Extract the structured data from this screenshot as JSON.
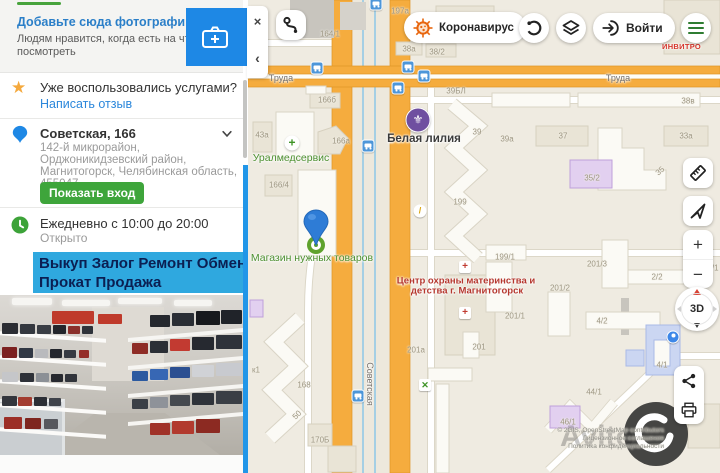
{
  "colors": {
    "brand_blue": "#1E88E5",
    "link_blue": "#2b87db",
    "green": "#3EA53B",
    "banner_bg": "#2FA8DF",
    "banner_text": "#0B1F52",
    "road_orange": "#F5AC3E",
    "map_bg": "#EFEBE1",
    "poi_green": "#4C8F2F",
    "poi_red": "#B5372E",
    "purple": "#6F4FA0"
  },
  "sidebar": {
    "photo_prompt": {
      "title": "Добавьте сюда фотографий!",
      "subtitle_line1": "Людям нравится, когда есть на что",
      "subtitle_line2": "посмотреть"
    },
    "review": {
      "question": "Уже воспользовались услугами?",
      "link": "Написать отзыв"
    },
    "address": {
      "title": "Советская, 166",
      "line1": "142-й микрорайон,",
      "line2": "Орджоникидзевский район,",
      "line3": "Магнитогорск, Челябинская область,",
      "line4": "455047",
      "entrance_button": "Показать вход"
    },
    "hours": {
      "schedule": "Ежедневно с 10:00 до 20:00",
      "status": "Открыто"
    },
    "banner": {
      "line1": "Выкуп Залог Ремонт Обмен",
      "line2": "Прокат Продажа"
    }
  },
  "map": {
    "panel": {
      "close": "×",
      "collapse": "‹"
    },
    "toolbar": {
      "coronavirus_label": "Коронавирус",
      "login_label": "Войти"
    },
    "invitro_label": "ИНВИТРО",
    "controls": {
      "zoom_in": "+",
      "zoom_out": "−",
      "threed": "3D"
    },
    "attribution": {
      "copyright": "© 2GIS, OpenStreetMap contributors",
      "license": "Лицензионное соглашение",
      "privacy": "Политика конфиденциальности"
    },
    "street_labels": [
      {
        "t": "Труда",
        "x": 281,
        "y": 78,
        "rot": 0
      },
      {
        "t": "Труда",
        "x": 618,
        "y": 78,
        "rot": 0
      },
      {
        "t": "Советская",
        "x": 370,
        "y": 384,
        "rot": 90
      }
    ],
    "building_labels": [
      {
        "t": "164/1",
        "x": 330,
        "y": 34
      },
      {
        "t": "197а",
        "x": 400,
        "y": 11
      },
      {
        "t": "38а",
        "x": 409,
        "y": 49
      },
      {
        "t": "38/2",
        "x": 437,
        "y": 52
      },
      {
        "t": "39БЛ",
        "x": 456,
        "y": 91
      },
      {
        "t": "38в",
        "x": 688,
        "y": 101
      },
      {
        "t": "166б",
        "x": 327,
        "y": 100
      },
      {
        "t": "43а",
        "x": 262,
        "y": 135
      },
      {
        "t": "166а",
        "x": 341,
        "y": 141
      },
      {
        "t": "166/4",
        "x": 279,
        "y": 185
      },
      {
        "t": "39",
        "x": 477,
        "y": 132
      },
      {
        "t": "39а",
        "x": 507,
        "y": 139
      },
      {
        "t": "37",
        "x": 563,
        "y": 136
      },
      {
        "t": "33а",
        "x": 686,
        "y": 136
      },
      {
        "t": "35/2",
        "x": 592,
        "y": 178
      },
      {
        "t": "35",
        "x": 660,
        "y": 171,
        "rot": -40
      },
      {
        "t": "199",
        "x": 460,
        "y": 202
      },
      {
        "t": "199/1",
        "x": 505,
        "y": 257
      },
      {
        "t": "201/3",
        "x": 597,
        "y": 264
      },
      {
        "t": "2/2",
        "x": 657,
        "y": 277
      },
      {
        "t": "2/1",
        "x": 713,
        "y": 268
      },
      {
        "t": "201/2",
        "x": 560,
        "y": 288
      },
      {
        "t": "201/1",
        "x": 515,
        "y": 316
      },
      {
        "t": "4/2",
        "x": 602,
        "y": 321
      },
      {
        "t": "201",
        "x": 479,
        "y": 347
      },
      {
        "t": "201а",
        "x": 416,
        "y": 350
      },
      {
        "t": "4/1",
        "x": 662,
        "y": 365
      },
      {
        "t": "168",
        "x": 304,
        "y": 385
      },
      {
        "t": "к1",
        "x": 256,
        "y": 370
      },
      {
        "t": "50",
        "x": 297,
        "y": 415,
        "rot": -45
      },
      {
        "t": "170Б",
        "x": 320,
        "y": 440
      },
      {
        "t": "44/1",
        "x": 594,
        "y": 392
      },
      {
        "t": "46/1",
        "x": 568,
        "y": 422
      }
    ],
    "pois": [
      {
        "t": "Уралмедсервис",
        "x": 291,
        "y": 158,
        "c": "green"
      },
      {
        "t": "Белая лилия",
        "x": 424,
        "y": 139,
        "c": "dark"
      },
      {
        "t": "Магазин нужных товаров",
        "x": 312,
        "y": 258,
        "c": "green"
      },
      {
        "t": "Центр охраны материнства и",
        "x": 466,
        "y": 281,
        "c": "red"
      },
      {
        "t": "детства г. Магнитогорск",
        "x": 467,
        "y": 291,
        "c": "red"
      }
    ],
    "bus_stops": [
      [
        376,
        4
      ],
      [
        317,
        68
      ],
      [
        408,
        67
      ],
      [
        424,
        76
      ],
      [
        398,
        88
      ],
      [
        368,
        146
      ],
      [
        358,
        396
      ]
    ]
  }
}
